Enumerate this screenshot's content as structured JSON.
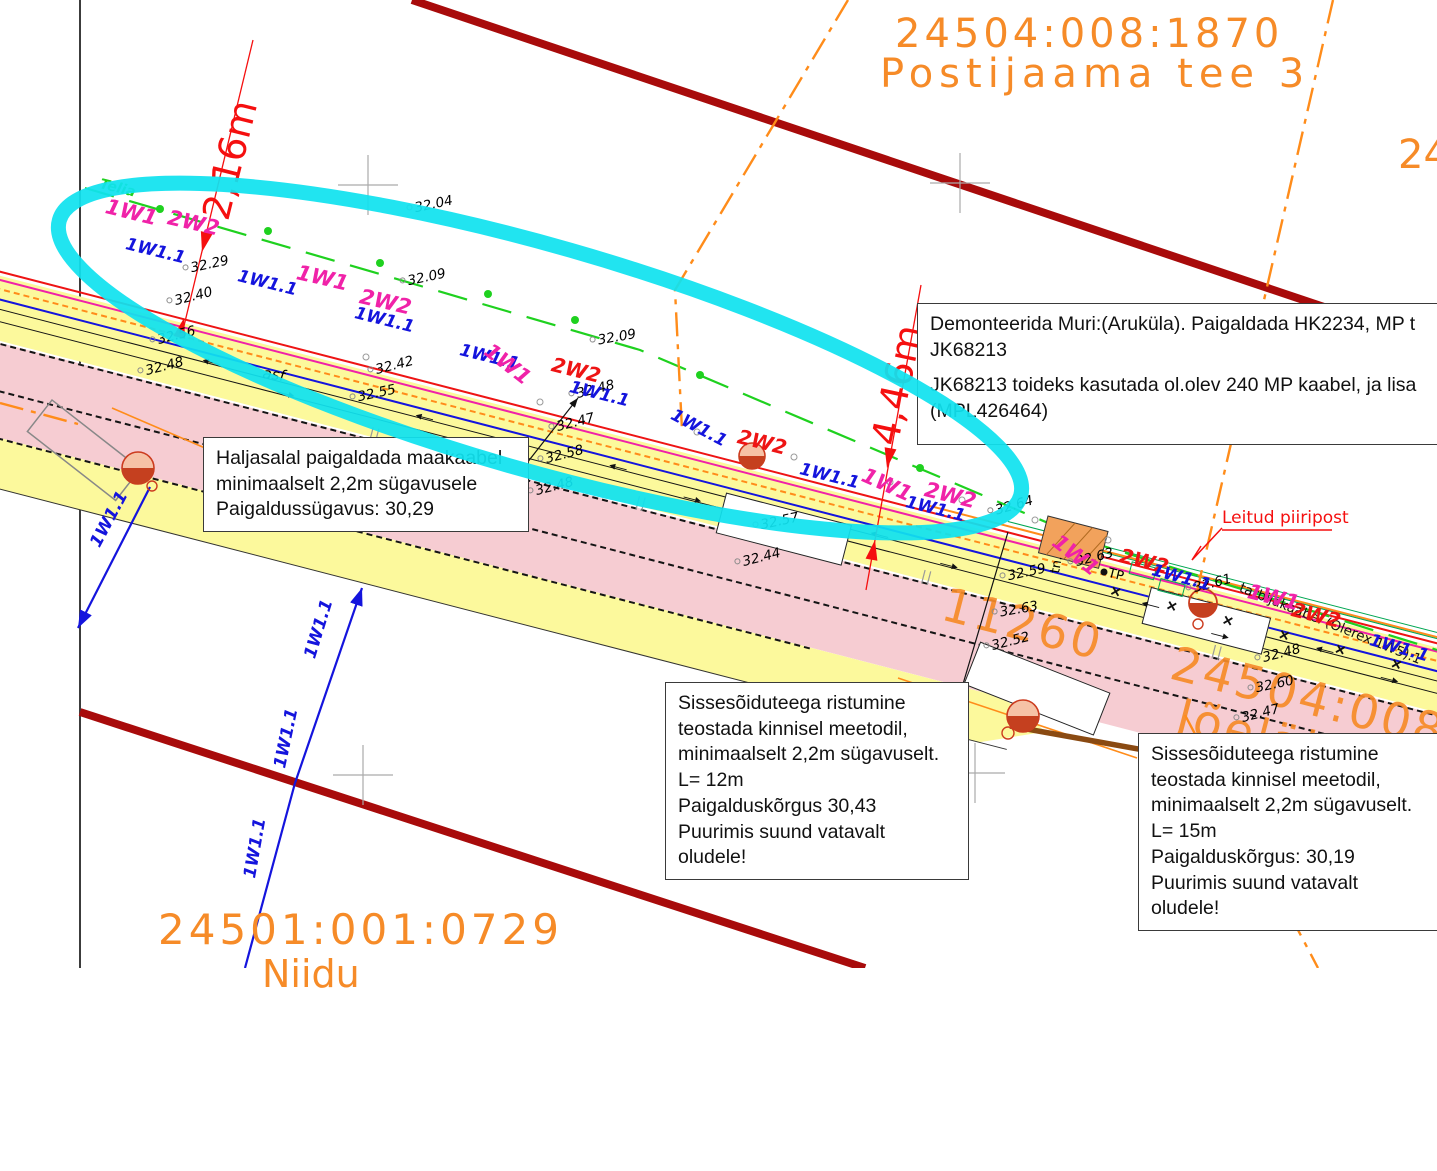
{
  "parcels": {
    "top": {
      "code": "24504:008:1870",
      "name": "Postijaama  tee  3"
    },
    "right_edge_partial": "24",
    "south_id": "11260",
    "south_code": "24504:008:0485",
    "south_name": "Jõelähtme—Ke",
    "bottom_left_code": "24501:001:0729",
    "bottom_left_partial_name": "Niidu"
  },
  "notes": {
    "demonteerida": {
      "lines": [
        "Demonteerida Muri:(Aruküla). Paigaldada HK2234, MP t",
        "JK68213",
        "",
        "JK68213 toideks kasutada ol.olev 240 MP kaabel, ja lisa",
        "(MPL426464)"
      ]
    },
    "haljasalal": {
      "lines": [
        "Haljasalal paigaldada maakaabel",
        "minimaalselt 2,2m sügavusele",
        "Paigaldussügavus: 30,29"
      ]
    },
    "crossing1": {
      "lines": [
        "Sissesõiduteega ristumine",
        "teostada kinnisel meetodil,",
        "minimaalselt 2,2m sügavuselt.",
        "L= 12m",
        "Paigalduskõrgus 30,43",
        "Puurimis suund vatavalt",
        "oludele!"
      ]
    },
    "crossing2": {
      "lines": [
        "Sissesõiduteega ristumine",
        "teostada kinnisel meetodil,",
        "minimaalselt 2,2m sügavuselt.",
        "L= 15m",
        "Paigalduskõrgus: 30,19",
        "Puurimis suund vatavalt",
        "oludele!"
      ]
    }
  },
  "dimensions": {
    "dim1": "2,16m",
    "dim2": "4,46m"
  },
  "map_labels": {
    "leitud_piiripost": "Leitud piiripost",
    "asf": "asf",
    "tn": "tn.",
    "tp": "TP",
    "consumer_cable": "tarbijakaabel (Olerex 1W5).1"
  },
  "elevations": [
    {
      "v": "32.04",
      "x": 407,
      "y": 202,
      "r": -12
    },
    {
      "v": "32.29",
      "x": 183,
      "y": 262,
      "r": -12
    },
    {
      "v": "32.09",
      "x": 400,
      "y": 275,
      "r": -12
    },
    {
      "v": "32.40",
      "x": 167,
      "y": 295,
      "r": -14
    },
    {
      "v": "32.56",
      "x": 150,
      "y": 334,
      "r": -14
    },
    {
      "v": "32.48",
      "x": 138,
      "y": 365,
      "r": -14
    },
    {
      "v": "32.42",
      "x": 368,
      "y": 364,
      "r": -14
    },
    {
      "v": "32.55",
      "x": 350,
      "y": 391,
      "r": -12
    },
    {
      "v": "32.09",
      "x": 590,
      "y": 334,
      "r": -10
    },
    {
      "v": "32.48",
      "x": 569,
      "y": 388,
      "r": -14
    },
    {
      "v": "32.47",
      "x": 549,
      "y": 421,
      "r": -14
    },
    {
      "v": "32.58",
      "x": 538,
      "y": 453,
      "r": -14
    },
    {
      "v": "32.48",
      "x": 528,
      "y": 485,
      "r": -14
    },
    {
      "v": "32.57",
      "x": 753,
      "y": 519,
      "r": -12
    },
    {
      "v": "32.44",
      "x": 735,
      "y": 556,
      "r": -14
    },
    {
      "v": "32.64",
      "x": 988,
      "y": 505,
      "r": -16
    },
    {
      "v": "32.63",
      "x": 1068,
      "y": 556,
      "r": -14
    },
    {
      "v": "32.61",
      "x": 1186,
      "y": 582,
      "r": -14
    },
    {
      "v": "32.59",
      "x": 1000,
      "y": 570,
      "r": -12
    },
    {
      "v": "32.63",
      "x": 992,
      "y": 606,
      "r": -10
    },
    {
      "v": "32.52",
      "x": 984,
      "y": 640,
      "r": -14
    },
    {
      "v": "32.48",
      "x": 1255,
      "y": 652,
      "r": -14
    },
    {
      "v": "32.60",
      "x": 1248,
      "y": 682,
      "r": -12
    },
    {
      "v": "32.47",
      "x": 1234,
      "y": 712,
      "r": -14
    }
  ],
  "cable_labels": [
    {
      "t": "Telia",
      "x": 100,
      "y": 176,
      "r": 14,
      "c": "green"
    },
    {
      "t": "1W1",
      "x": 106,
      "y": 194,
      "r": 14,
      "c": "magenta"
    },
    {
      "t": "2W2",
      "x": 168,
      "y": 205,
      "r": 13,
      "c": "magenta"
    },
    {
      "t": "1W1.1",
      "x": 126,
      "y": 234,
      "r": 14,
      "c": "blue"
    },
    {
      "t": "1W1.1",
      "x": 238,
      "y": 266,
      "r": 14,
      "c": "blue"
    },
    {
      "t": "1W1",
      "x": 297,
      "y": 260,
      "r": 13,
      "c": "magenta"
    },
    {
      "t": "2W2",
      "x": 360,
      "y": 284,
      "r": 13,
      "c": "magenta"
    },
    {
      "t": "1W1.1",
      "x": 355,
      "y": 303,
      "r": 14,
      "c": "blue"
    },
    {
      "t": "1W1.1",
      "x": 460,
      "y": 340,
      "r": 14,
      "c": "blue"
    },
    {
      "t": "1W1",
      "x": 487,
      "y": 336,
      "r": 38,
      "c": "magenta"
    },
    {
      "t": "2W2",
      "x": 552,
      "y": 352,
      "r": 14,
      "c": "red"
    },
    {
      "t": "1W1.1",
      "x": 570,
      "y": 377,
      "r": 14,
      "c": "blue"
    },
    {
      "t": "1W1.1",
      "x": 672,
      "y": 404,
      "r": 28,
      "c": "blue"
    },
    {
      "t": "2W2",
      "x": 738,
      "y": 424,
      "r": 14,
      "c": "red"
    },
    {
      "t": "1W1.1",
      "x": 800,
      "y": 459,
      "r": 14,
      "c": "blue"
    },
    {
      "t": "1W1",
      "x": 863,
      "y": 462,
      "r": 24,
      "c": "magenta"
    },
    {
      "t": "2W2",
      "x": 925,
      "y": 477,
      "r": 14,
      "c": "magenta"
    },
    {
      "t": "1W1.1",
      "x": 906,
      "y": 492,
      "r": 14,
      "c": "blue"
    },
    {
      "t": "1W1",
      "x": 1055,
      "y": 527,
      "r": 38,
      "c": "magenta"
    },
    {
      "t": "2W2",
      "x": 1120,
      "y": 543,
      "r": 14,
      "c": "red"
    },
    {
      "t": "1W1.1",
      "x": 1152,
      "y": 560,
      "r": 15,
      "c": "blue"
    },
    {
      "t": "1W1",
      "x": 1248,
      "y": 579,
      "r": 14,
      "c": "magenta"
    },
    {
      "t": "2W2",
      "x": 1292,
      "y": 597,
      "r": 14,
      "c": "red"
    },
    {
      "t": "1W1.1",
      "x": 1370,
      "y": 630,
      "r": 16,
      "c": "blue"
    },
    {
      "t": "1W1.1",
      "x": 95,
      "y": 536,
      "r": -62,
      "c": "blue"
    },
    {
      "t": "1W1.1",
      "x": 310,
      "y": 648,
      "r": -73,
      "c": "blue"
    },
    {
      "t": "1W1.1",
      "x": 280,
      "y": 758,
      "r": -78,
      "c": "blue"
    },
    {
      "t": "1W1.1",
      "x": 250,
      "y": 868,
      "r": -80,
      "c": "blue"
    }
  ],
  "colors": {
    "cadastral_orange": "#f68b28",
    "boundary_darkred": "#a80b0b",
    "highlight_cyan": "#10e2ef",
    "cable_blue": "#1414dd",
    "cable_magenta": "#f022a8",
    "cable_red": "#ee1414",
    "telia_green": "#1fd11f",
    "road_yellow": "#fcf99c",
    "road_pink": "#f6ccd2"
  }
}
